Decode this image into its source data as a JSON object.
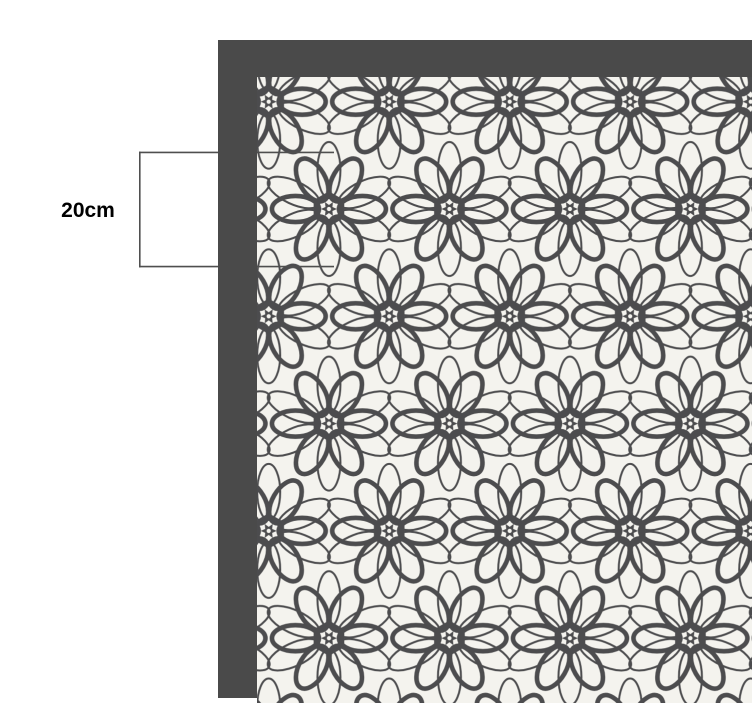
{
  "diagram": {
    "measurement": {
      "label": "20cm"
    },
    "pattern": {
      "motif": "six-petal-spirograph-flower",
      "center": "hexagon-with-star",
      "layout": "hexagonal-half-drop-repeat"
    },
    "colors": {
      "page_background": "#ffffff",
      "frame": "#4a4a4a",
      "pattern_background": "#f4f3ee",
      "motif_stroke": "#4c4c4e",
      "bracket_line": "#4f4f4f",
      "label_text": "#000000"
    }
  }
}
